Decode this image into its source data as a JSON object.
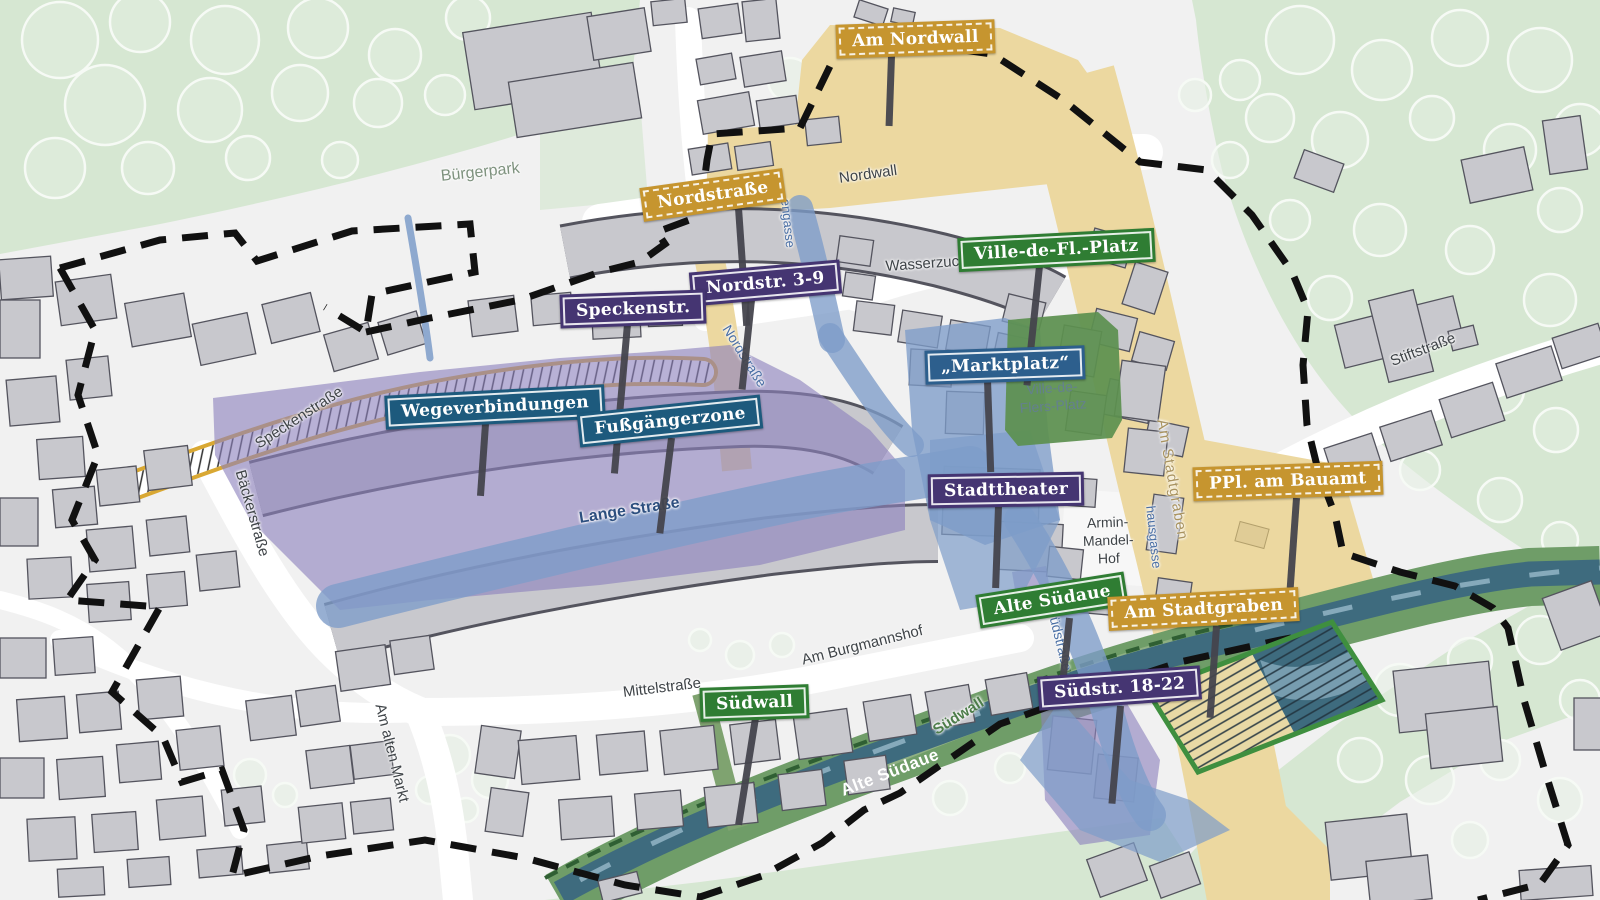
{
  "signs": [
    {
      "label": "Am Nordwall",
      "style": "gold"
    },
    {
      "label": "Nordstraße",
      "style": "gold"
    },
    {
      "label": "Nordstr. 3-9",
      "style": "purple"
    },
    {
      "label": "Speckenstr.",
      "style": "purple"
    },
    {
      "label": "Ville-de-Fl.-Platz",
      "style": "green"
    },
    {
      "label": "„Marktplatz“",
      "style": "blue"
    },
    {
      "label": "Wegeverbindungen",
      "style": "teal"
    },
    {
      "label": "Fußgängerzone",
      "style": "teal"
    },
    {
      "label": "Stadttheater",
      "style": "purple"
    },
    {
      "label": "PPl. am Bauamt",
      "style": "gold"
    },
    {
      "label": "Alte Südaue",
      "style": "green"
    },
    {
      "label": "Am Stadtgraben",
      "style": "gold"
    },
    {
      "label": "Südstr. 18-22",
      "style": "purple"
    },
    {
      "label": "Südwall",
      "style": "green"
    }
  ],
  "streets": [
    {
      "text": "Bürgerpark"
    },
    {
      "text": "Nordwall"
    },
    {
      "text": "Wasserzucht"
    },
    {
      "text": "Speckenstraße"
    },
    {
      "text": "Bäckerstraße"
    },
    {
      "text": "Lange Straße"
    },
    {
      "text": "Nordstraße"
    },
    {
      "text": "engasse"
    },
    {
      "text": "hausgasse"
    },
    {
      "text": "Südstraße"
    },
    {
      "text": "Am Stadtgraben"
    },
    {
      "text": "Mittelstraße"
    },
    {
      "text": "Am Burgmannshof"
    },
    {
      "text": "Am alten Markt"
    },
    {
      "text": "Stiftstraße"
    },
    {
      "text": "Südwall"
    },
    {
      "text": "Alte Südaue"
    }
  ],
  "areas": {
    "ville_line1": "Ville-de-",
    "ville_line2": "Flers-Platz",
    "armin_line1": "Armin-",
    "armin_line2": "Mandel-",
    "armin_line3": "Hof"
  },
  "colors": {
    "sign_gold": "#c6952f",
    "sign_purple": "#453572",
    "sign_green": "#2f7d33",
    "sign_blue": "#2d5f8d",
    "sign_teal": "#1d5a7d",
    "pedestrian_zone_blue": "#7d9cc9",
    "zone_purple": "#8d81bd",
    "park_green": "#d6e7d2",
    "square_green": "#5d9050",
    "road_tan": "#ecd8a0",
    "river_teal": "#3e6b7e",
    "bank_green": "#6f9d68",
    "boundary_black": "#111111",
    "building_gray": "#c8c8cd"
  }
}
